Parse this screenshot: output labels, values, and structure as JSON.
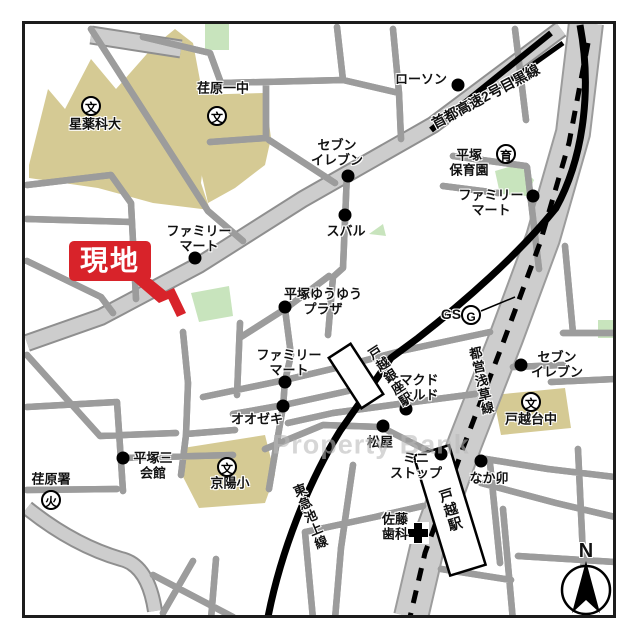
{
  "site": {
    "label": "現地"
  },
  "compass": {
    "north": "N"
  },
  "watermark": "Property Bank",
  "colors": {
    "site_red": "#d8232a",
    "school_area_beige": "#d5ca94",
    "park_green": "#c8e4bd",
    "road_gray": "#c8c8c8",
    "major_road_gray": "#cdcdcd",
    "rail_black": "#000000"
  },
  "symbols": {
    "school": "文",
    "fire_station": "火",
    "nursery": "育",
    "gas_station": "G"
  },
  "roads": {
    "expressway": "首都高速2号目黒線",
    "subway_line": "都営浅草線",
    "rail_line": "東急池上線"
  },
  "stations": {
    "togoshi_ginza": "戸越銀座駅",
    "togoshi": "戸越駅"
  },
  "places": {
    "hoshi_univ": "星薬科大",
    "ebara_jhs": "荏原一中",
    "lawson": "ローソン",
    "hoikuen": "平塚\n保育園",
    "famima_ne": "ファミリー\nマート",
    "seven_north": "セブン\nイレブン",
    "subaru": "スバル",
    "famima_nw": "ファミリー\nマート",
    "plaza": "平塚ゆうゆう\nプラザ",
    "gs": "GS",
    "seven_east": "セブン\nイレブン",
    "togoshidai_jhs": "戸越台中",
    "famima_s": "ファミリー\nマート",
    "ozeki": "オオゼキ",
    "mcdonalds": "マクド\nナルド",
    "matsuya": "松屋",
    "ministop": "ミニ\nストップ",
    "nakau": "なか卯",
    "hiratsuka3_hall": "平塚三\n会館",
    "ebara_fire": "荏原署",
    "kyoyo_es": "京陽小",
    "sato_dental": "佐藤\n歯科"
  }
}
